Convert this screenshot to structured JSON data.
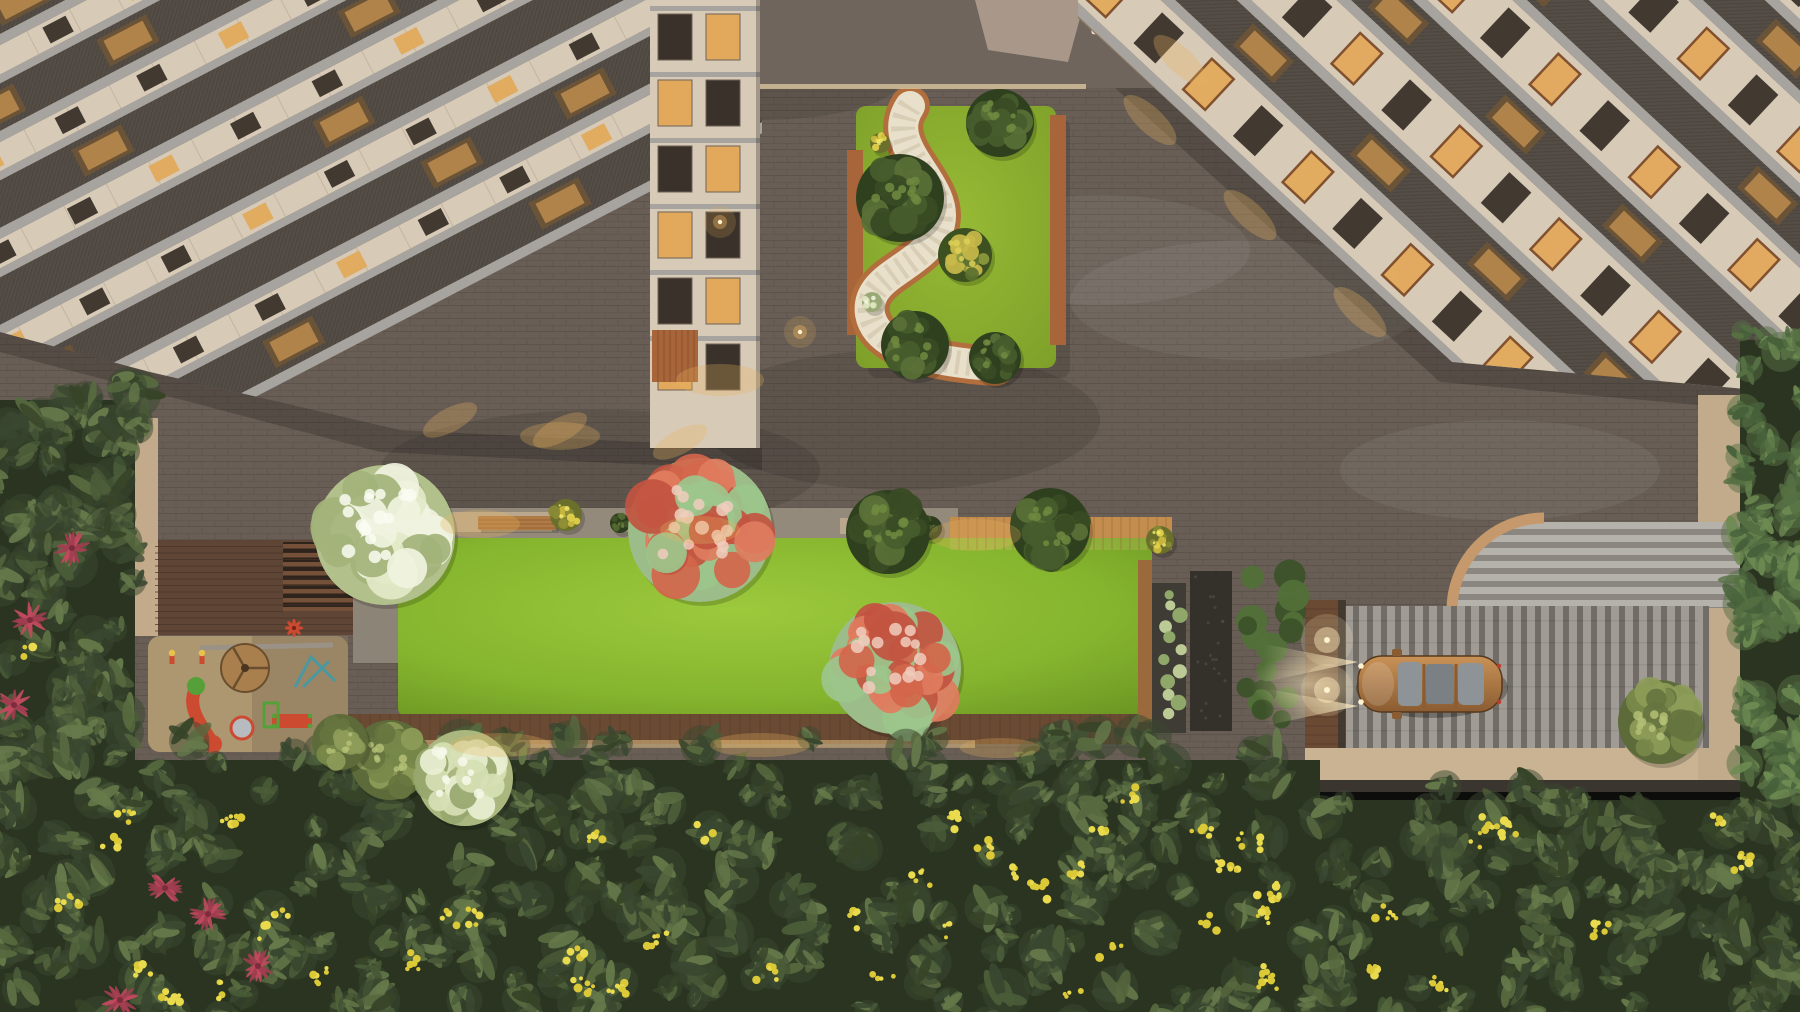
{
  "meta": {
    "title": "Aerial dusk render of residential courtyard with gardens, playground, lawn and driveway",
    "type": "architectural-3d-render-top-view"
  },
  "palette": {
    "plaza_base": "#685e55",
    "plaza_smooth": "#6f655c",
    "brick_line": "#39322b",
    "light_band": "#d8c49c",
    "island_lawn1": "#97ba35",
    "island_lawn2": "#7a9c28",
    "path_fill": "#e9e0cb",
    "path_edge": "#b26e3c",
    "path_dash": "#cbc0a6",
    "terr_wood": "#a8653a",
    "wood_strip": "#9a6a3d",
    "lawn1": "#85b42e",
    "lawn3": "#628a1e",
    "band_concrete": "#948a7c",
    "band_lit": "#c2ae92",
    "bench": "#b07a45",
    "wood_band": "#b9803f",
    "wood_band_line": "#8a5c2c",
    "deck_wood": "#5e4535",
    "deck_line": "#483327",
    "pergola_bar": "#75513a",
    "pergola_gap": "#2e241c",
    "wall_beige": "#c3aa8a",
    "path_gray": "#8d8478",
    "bottom_wood": "#6b4a33",
    "lit_warm": "#e8c68a",
    "sand1": "#ad9770",
    "sand2": "#8a775c",
    "planter_frame": "#3f3b35",
    "plant_light": "#c3d29b",
    "plant_mid": "#94ad6b",
    "pebble": "#34312b",
    "shrub_dark": "#3c5229",
    "shrub_mid": "#527038",
    "lamp_col": "#6b4a33",
    "hs_base": "#a19d97",
    "hs_light": "#b5b1ab",
    "hs_dark": "#8b8780",
    "tan": "#c5996b",
    "dr_base": "#8c8881",
    "dr_light": "#a09c95",
    "dr_dark": "#716d66",
    "apron": "#c9b392",
    "beige_col": "#c2ab8b",
    "dark_band": "#3a352e",
    "car_body1": "#c99257",
    "car_body2": "#8a5c31",
    "car_glass": "#8d9397",
    "car_glass2": "#7a8084",
    "car_line": "#55381d",
    "beam": "#ffeec2",
    "lamp_bright": "#fff3cf",
    "passage_beige": "#a9988a",
    "awning_base": "#c98f4e",
    "awning_stripe": "#e8dcc8",
    "bld_beige": "#d7cab6",
    "bld_beige2": "#c9bca8",
    "slab": "#a7a39e",
    "screen": "#544d46",
    "seam": "#b5a792",
    "win_dark": "#3a322a",
    "win_warm": "#e2a95c",
    "win_wood": "#7d4a28",
    "roof_glow": "#c0904e",
    "roof_dark": "#6b5338",
    "glow": "#e8b25f",
    "forest_base": "#2a3420",
    "yellow1": "#dcc937",
    "yellow2": "#e9da4e",
    "red_plant": "#a13d50",
    "red_plant2": "#c04a5e",
    "pg_red": "#cc4a30",
    "pg_green": "#56a03a",
    "pg_teal": "#4a98a0",
    "pg_wood": "#a97f4e",
    "pg_gray": "#9a9287",
    "pg_metal": "#b7bbbf",
    "pg_head": "#e8c24a"
  },
  "treekinds": {
    "dark": {
      "base": "#2f401f",
      "blobs": [
        "#475c2d",
        "#5a7037",
        "#394b24"
      ],
      "hi": "#70893f"
    },
    "olive": {
      "base": "#5d6b3a",
      "blobs": [
        "#77894a",
        "#8d9c58",
        "#66753f"
      ],
      "hi": "#b3bf75"
    },
    "pale": {
      "base": "#aab87f",
      "blobs": [
        "#d6dfb4",
        "#e9efd2",
        "#97a76e"
      ],
      "hi": "#f6f8e9"
    },
    "white": {
      "base": "#b2c08c",
      "blobs": [
        "#e2e9c8",
        "#f0f3df",
        "#a3b37a"
      ],
      "hi": "#fafbf2"
    },
    "red": {
      "base": "#9cbd89",
      "blobs": [
        "#d2664b",
        "#df7c5e",
        "#9cc68c",
        "#c25440"
      ],
      "hi": "#f0cdbd"
    },
    "mixedy": {
      "base": "#3c5020",
      "blobs": [
        "#5a7030",
        "#8e9b3d",
        "#c8b94a"
      ],
      "hi": "#ddd058"
    },
    "yellowshrub": {
      "base": "#6a702c",
      "blobs": [
        "#cdbb3f",
        "#e3d34c",
        "#8a8a34"
      ],
      "hi": "#f0e66a"
    },
    "whiteshrub": {
      "base": "#9aa876",
      "blobs": [
        "#dfe6c2",
        "#c7d4a0"
      ],
      "hi": "#f3f6e4"
    },
    "darkshrub": {
      "base": "#2c3c1d",
      "blobs": [
        "#415427",
        "#546a32"
      ],
      "hi": "#687f3d"
    },
    "palm": {
      "base": "#3f5330",
      "blobs": [
        "#567043",
        "#6d8a52",
        "#46603a"
      ],
      "hi": "#86a463"
    }
  },
  "scene": {
    "canvas": {
      "w": 1800,
      "h": 1012
    },
    "plaza": {
      "mottles": [
        [
          300,
          200,
          160,
          60,
          1
        ],
        [
          900,
          420,
          200,
          70,
          1
        ],
        [
          1250,
          300,
          180,
          60,
          0
        ],
        [
          600,
          470,
          220,
          60,
          1
        ],
        [
          1500,
          470,
          160,
          50,
          0
        ],
        [
          760,
          80,
          140,
          40,
          1
        ],
        [
          1100,
          250,
          150,
          55,
          0
        ]
      ]
    },
    "island": {
      "lawn": [
        856,
        106,
        200,
        262
      ],
      "path_d": "M 910 106 C 882 148, 950 182, 940 224 C 930 268, 864 272, 870 314 C 876 348, 930 362, 995 366",
      "wood": [
        [
          847,
          150,
          16,
          185
        ],
        [
          1050,
          115,
          16,
          230
        ]
      ],
      "trees": [
        [
          900,
          198,
          44,
          "dark"
        ],
        [
          1000,
          123,
          34,
          "dark"
        ],
        [
          915,
          345,
          34,
          "dark"
        ],
        [
          965,
          255,
          27,
          "mixedy"
        ],
        [
          995,
          358,
          26,
          "dark"
        ]
      ],
      "shrubs": [
        [
          872,
          302,
          10,
          "whiteshrub"
        ],
        [
          893,
          168,
          12,
          "yellowshrub"
        ],
        [
          880,
          143,
          10,
          "yellowshrub"
        ]
      ],
      "shadow": [
        862,
        112,
        202,
        260
      ]
    },
    "terrace": {
      "band": [
        398,
        508,
        560,
        30
      ],
      "band_lit": [
        [
          402,
          512,
          150,
          20
        ],
        [
          620,
          514,
          110,
          18
        ],
        [
          840,
          518,
          90,
          16
        ]
      ],
      "wood_band": [
        950,
        517,
        222,
        33
      ],
      "benches": [
        [
          478,
          516,
          78,
          14
        ]
      ],
      "lawn": [
        398,
        538,
        754,
        180
      ],
      "deck": [
        155,
        540,
        198,
        95
      ],
      "pergola": [
        283,
        542,
        70,
        66
      ],
      "wall": [
        118,
        418,
        40,
        218
      ],
      "path_left": [
        353,
        537,
        45,
        126
      ],
      "bottom_wood": [
        320,
        714,
        832,
        30
      ],
      "bottom_lit": [
        335,
        740,
        640,
        8
      ],
      "trees": [
        [
          385,
          535,
          70,
          "white"
        ],
        [
          700,
          530,
          72,
          "red"
        ],
        [
          888,
          532,
          42,
          "dark"
        ],
        [
          1050,
          528,
          40,
          "dark"
        ],
        [
          895,
          668,
          66,
          "red"
        ]
      ],
      "shrubs": [
        [
          566,
          515,
          16,
          "yellowshrub"
        ],
        [
          620,
          523,
          10,
          "darkshrub"
        ],
        [
          930,
          528,
          12,
          "darkshrub"
        ],
        [
          418,
          516,
          12,
          "darkshrub"
        ],
        [
          1160,
          540,
          14,
          "yellowshrub"
        ]
      ]
    },
    "playground": {
      "sand": [
        148,
        636,
        200,
        116
      ],
      "shade": [
        252,
        636,
        96,
        116
      ],
      "beam": [
        200,
        648,
        333,
        645
      ],
      "merry": [
        245,
        668,
        24
      ],
      "slide": {
        "d": "M 196 688 C 186 706 200 724 212 742",
        "cap": [
          213,
          744,
          9
        ],
        "top": [
          196,
          686,
          9
        ]
      },
      "cyl": [
        242,
        728,
        11
      ],
      "redbox": [
        272,
        714,
        40,
        14
      ],
      "teal": [
        295,
        657,
        40,
        30
      ],
      "bench": [
        264,
        703,
        14,
        24
      ],
      "kids": [
        [
          172,
          658
        ],
        [
          202,
          658
        ]
      ],
      "pinwheel": [
        294,
        628,
        8
      ]
    },
    "rightstrip": {
      "woodstrip": [
        1138,
        560,
        14,
        162
      ],
      "planter": [
        1152,
        583,
        34,
        150
      ],
      "pebble": [
        1190,
        571,
        42,
        160
      ],
      "shrubcol": [
        1233,
        566,
        72,
        165
      ],
      "lampcol": [
        1305,
        600,
        40,
        170
      ],
      "lamps": [
        [
          1327,
          640
        ],
        [
          1327,
          690
        ]
      ]
    },
    "paving": {
      "hs_shape": "M1457,608 A86,86 0 0 1 1543,522 L1800,522 L1800,608 Z",
      "tan_arc": "M1452,612 A92,92 0 0 1 1544,518",
      "drive": [
        1345,
        606,
        353,
        142
      ],
      "apron": [
        1305,
        748,
        437,
        32
      ],
      "beige_col": [
        1698,
        395,
        46,
        385
      ],
      "dark_h": [
        1298,
        780,
        452,
        12
      ]
    },
    "car": {
      "body": [
        1358,
        656,
        144,
        56
      ],
      "glass": [
        [
          1398,
          662,
          24,
          44
        ],
        [
          1426,
          664,
          28,
          40
        ],
        [
          1458,
          663,
          26,
          42
        ]
      ],
      "mirrors": [
        [
          1392,
          649,
          10,
          7
        ],
        [
          1392,
          712,
          10,
          7
        ]
      ],
      "shadow": [
        1432,
        688,
        76,
        30
      ]
    },
    "passage": {
      "smooth": [
        750,
        0,
        430,
        88
      ],
      "light_line": [
        756,
        84,
        330,
        5
      ],
      "beige_wedge": "975,0 1085,0 1068,62 988,50",
      "awning": "1085,0 1290,0 1252,46 1092,34"
    },
    "buildings": {
      "left": {
        "clip": "0,0 655,0 762,120 762,448 400,430 150,372 0,332",
        "origin": [
          0,
          336
        ],
        "angle": -27.5,
        "x0": -220,
        "len": 1060,
        "bases": [
          172,
          86,
          0,
          -86,
          -172,
          -258,
          -344,
          -430
        ],
        "segs": [
          [
            10,
            "slab"
          ],
          [
            42,
            "screen"
          ],
          [
            8,
            "slab"
          ],
          [
            26,
            "wall"
          ]
        ],
        "win": {
          "w": 26,
          "h": 18,
          "gap": 92,
          "lit": 3
        },
        "roof_gap": 150,
        "facade": {
          "x": 650,
          "y": 0,
          "w": 110,
          "h": 448,
          "cols": [
            658,
            706
          ],
          "winw": 34,
          "winh": 46,
          "rows": [
            14,
            80,
            146,
            212,
            278,
            344
          ],
          "slabs": [
            6,
            72,
            138,
            204,
            270,
            336
          ],
          "wood": [
            652,
            330,
            46,
            52
          ]
        }
      },
      "right": {
        "clip": "1078,0 1800,0 1800,394 1452,362 1078,18",
        "origin": [
          1078,
          16
        ],
        "angle": 43,
        "x0": -100,
        "len": 860,
        "bases": [
          120,
          0,
          -120,
          -240,
          -360,
          -480
        ],
        "segs": [
          [
            10,
            "slab"
          ],
          [
            58,
            "wallwin"
          ],
          [
            10,
            "slab"
          ],
          [
            42,
            "screen"
          ]
        ],
        "win": {
          "w": 30,
          "h": 42,
          "gap": 68
        },
        "roof_gap": 160,
        "edge_glow": {
          "x0": 20,
          "x1": 520,
          "step": 95,
          "w": 64,
          "h": 12
        }
      }
    },
    "forest": {
      "base": [
        [
          -20,
          760,
          1340,
          280
        ],
        [
          1290,
          800,
          540,
          230
        ],
        [
          -15,
          400,
          150,
          620
        ],
        [
          1740,
          340,
          80,
          470
        ]
      ],
      "regions": [
        {
          "x0": -20,
          "x1": 1310,
          "y0": 735,
          "y1": 1035,
          "n": 300
        },
        {
          "x0": 1300,
          "x1": 1820,
          "y0": 778,
          "y1": 1035,
          "n": 110
        },
        {
          "x0": -15,
          "x1": 138,
          "y0": 385,
          "y1": 770,
          "n": 90
        },
        {
          "x0": 1738,
          "x1": 1815,
          "y0": 325,
          "y1": 800,
          "n": 70,
          "palm": true
        }
      ],
      "colors": [
        "#394730",
        "#4a5c38",
        "#57693f",
        "#65794a",
        "#374428"
      ],
      "yellow_n": 52,
      "red": [
        [
          30,
          620
        ],
        [
          14,
          705
        ],
        [
          72,
          548
        ],
        [
          165,
          888
        ],
        [
          208,
          914
        ],
        [
          258,
          966
        ],
        [
          120,
          1000
        ]
      ],
      "light_trees": [
        [
          390,
          760,
          40,
          "olive"
        ],
        [
          465,
          778,
          48,
          "pale"
        ],
        [
          1660,
          722,
          42,
          "olive"
        ],
        [
          340,
          742,
          28,
          "olive"
        ]
      ]
    },
    "lights": {
      "lamps": [
        [
          720,
          222
        ],
        [
          800,
          332
        ]
      ],
      "glows": [
        [
          480,
          524,
          40,
          14
        ],
        [
          700,
          530,
          40,
          14
        ],
        [
          975,
          535,
          46,
          16
        ],
        [
          500,
          745,
          50,
          12
        ],
        [
          760,
          745,
          50,
          12
        ],
        [
          1000,
          748,
          40,
          10
        ],
        [
          720,
          380,
          44,
          16
        ],
        [
          560,
          436,
          40,
          14
        ]
      ],
      "bldL": [
        [
          450,
          420
        ],
        [
          560,
          430
        ],
        [
          680,
          442
        ]
      ],
      "bldR": [
        [
          1150,
          120
        ],
        [
          1250,
          215
        ],
        [
          1360,
          312
        ],
        [
          1180,
          60
        ]
      ]
    }
  }
}
